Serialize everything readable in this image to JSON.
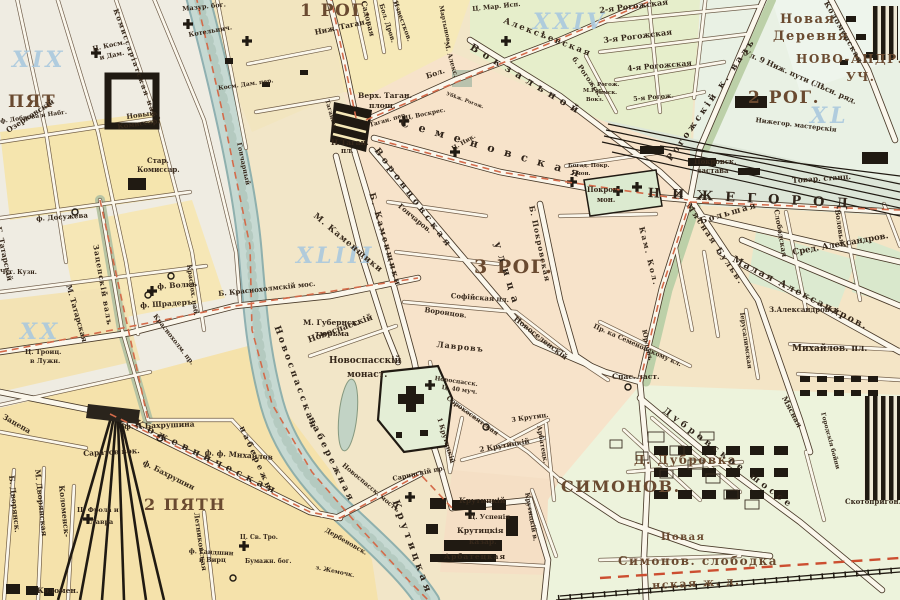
{
  "colors": {
    "paper": "#f2e6c8",
    "river": "#c6d9d2",
    "block_pink": "#f7e3ca",
    "block_yellow": "#f5e5ae",
    "block_green": "#e6eecb",
    "road_fill": "#fbf7ec",
    "building_black": "#201a12",
    "tram_line_red": "#d46b4a",
    "sheet_number_blue": "#aac9de",
    "label_brown": "#35271a",
    "district_brown": "#6a4a30"
  },
  "sheet_numbers": [
    "XIX",
    "XX",
    "XXIV",
    "XL",
    "XLIII"
  ],
  "districts": [
    "1 РОГ.",
    "2 РОГ.",
    "3 РОГ.",
    "ПЯТ",
    "2 ПЯТН",
    "СИМОНОВ."
  ],
  "labels": [
    {
      "t": "1 РОГ.",
      "x": 300,
      "y": 3,
      "s": 17,
      "c": "big",
      "n": "district-label-1-rog"
    },
    {
      "t": "2 РОГ.",
      "x": 748,
      "y": 90,
      "s": 17,
      "c": "big",
      "n": "district-label-2-rog"
    },
    {
      "t": "3 РОГ.",
      "x": 474,
      "y": 258,
      "s": 19,
      "c": "big",
      "n": "district-label-3-rog"
    },
    {
      "t": "ПЯТ",
      "x": 8,
      "y": 94,
      "s": 17,
      "c": "big",
      "n": "district-label-pyat"
    },
    {
      "t": "2 ПЯТН",
      "x": 144,
      "y": 497,
      "s": 16,
      "c": "big",
      "n": "district-label-2-pyatn"
    },
    {
      "t": "СИМОНОВ.",
      "x": 561,
      "y": 479,
      "s": 16,
      "c": "big",
      "n": "district-label-simonov"
    },
    {
      "t": "Д. Дубровка",
      "x": 634,
      "y": 455,
      "s": 12,
      "c": "big",
      "n": "village-label-dubrovka"
    },
    {
      "t": "Новая",
      "x": 780,
      "y": 14,
      "s": 13,
      "c": "big"
    },
    {
      "t": "Деревня",
      "x": 773,
      "y": 31,
      "s": 13,
      "c": "big"
    },
    {
      "t": "НОВО-АНДР.",
      "x": 796,
      "y": 54,
      "s": 12,
      "c": "big"
    },
    {
      "t": "УЧ.",
      "x": 846,
      "y": 72,
      "s": 12,
      "c": "big"
    },
    {
      "t": "Симонов. слободка",
      "x": 618,
      "y": 556,
      "s": 12,
      "c": "big"
    },
    {
      "t": "Новая",
      "x": 661,
      "y": 533,
      "s": 10,
      "c": "big"
    },
    {
      "t": "нская ж. д.",
      "x": 652,
      "y": 581,
      "r": -3,
      "s": 11,
      "c": "big"
    },
    {
      "t": "XIX",
      "x": 12,
      "y": 50,
      "s": 22,
      "c": "blue",
      "n": "sheet-number-xix"
    },
    {
      "t": "XX",
      "x": 20,
      "y": 322,
      "s": 22,
      "c": "blue",
      "n": "sheet-number-xx"
    },
    {
      "t": "XXIV",
      "x": 533,
      "y": 12,
      "s": 22,
      "c": "blue",
      "n": "sheet-number-xxiv"
    },
    {
      "t": "XL",
      "x": 810,
      "y": 106,
      "s": 22,
      "c": "blue",
      "n": "sheet-number-xl"
    },
    {
      "t": "XLIII",
      "x": 296,
      "y": 246,
      "s": 22,
      "c": "blue",
      "n": "sheet-number-xliii"
    },
    {
      "t": "Комиссаріатская наб.",
      "x": 118,
      "y": 8,
      "r": 70,
      "s": 7,
      "l": 1.5
    },
    {
      "t": "Новый",
      "x": 126,
      "y": 114,
      "r": -8,
      "s": 7
    },
    {
      "t": "Комиссар.",
      "x": 117,
      "y": 124,
      "r": -8,
      "s": 7
    },
    {
      "t": "Стар.",
      "x": 147,
      "y": 158,
      "s": 7
    },
    {
      "t": "Комиссар.",
      "x": 137,
      "y": 167,
      "s": 7
    },
    {
      "t": "Мазур. бог.",
      "x": 182,
      "y": 6,
      "r": -6,
      "s": 6.5
    },
    {
      "t": "Ц. Косм.",
      "x": 92,
      "y": 46,
      "r": -12,
      "s": 6.5
    },
    {
      "t": "и Дам.",
      "x": 99,
      "y": 55,
      "r": -12,
      "s": 6.5
    },
    {
      "t": "Котельнич.",
      "x": 188,
      "y": 32,
      "r": -10,
      "s": 6.5
    },
    {
      "t": "Косм. Дам. пер.",
      "x": 218,
      "y": 86,
      "r": -8,
      "s": 6
    },
    {
      "t": "Гончарный",
      "x": 242,
      "y": 142,
      "r": 78,
      "s": 6.5
    },
    {
      "t": "ф. Досужева",
      "x": 36,
      "y": 216,
      "r": -4,
      "s": 7
    },
    {
      "t": "Озерковскій",
      "x": 5,
      "y": 128,
      "r": -33,
      "s": 7.5
    },
    {
      "t": "ф. Доброва и Набг.",
      "x": 0,
      "y": 119,
      "r": -8,
      "s": 6
    },
    {
      "t": "Б. Татарскій",
      "x": 2,
      "y": 226,
      "r": 78,
      "s": 7.5
    },
    {
      "t": "М. Татарская",
      "x": 72,
      "y": 284,
      "r": 74,
      "s": 7.5
    },
    {
      "t": "Чуг. Кузн.",
      "x": 0,
      "y": 270,
      "s": 6
    },
    {
      "t": "Зацепскій валъ",
      "x": 99,
      "y": 244,
      "r": 80,
      "s": 7.5,
      "l": 1
    },
    {
      "t": "Ц. Троиц.",
      "x": 25,
      "y": 349,
      "s": 6.5
    },
    {
      "t": "в Лужн.",
      "x": 30,
      "y": 358,
      "s": 6.5
    },
    {
      "t": "ф. Волкъ",
      "x": 157,
      "y": 283,
      "r": -4,
      "s": 7.5
    },
    {
      "t": "ф. Шрадеръ",
      "x": 140,
      "y": 302,
      "r": -4,
      "s": 7.5
    },
    {
      "t": "Краснох. наб.",
      "x": 192,
      "y": 264,
      "r": 82,
      "s": 6.5
    },
    {
      "t": "Б. Краснохолмскій мос.",
      "x": 218,
      "y": 291,
      "r": -6,
      "s": 7
    },
    {
      "t": "Краснохолм. пр.",
      "x": 157,
      "y": 313,
      "r": 52,
      "s": 6.5
    },
    {
      "t": "Зацепа",
      "x": 5,
      "y": 413,
      "r": 30,
      "s": 7.5
    },
    {
      "t": "Б. Дворянск.",
      "x": 15,
      "y": 475,
      "r": 84,
      "s": 7.5
    },
    {
      "t": "М. Дворянская",
      "x": 41,
      "y": 469,
      "r": 84,
      "s": 7.5
    },
    {
      "t": "Коломенск-",
      "x": 65,
      "y": 485,
      "r": 84,
      "s": 7.5
    },
    {
      "t": "Коломен.",
      "x": 37,
      "y": 587,
      "s": 7.5
    },
    {
      "t": "ф. А.Бахрушина",
      "x": 124,
      "y": 423,
      "r": -2,
      "s": 7.5
    },
    {
      "t": "Саратов вок.",
      "x": 83,
      "y": 450,
      "r": -3,
      "s": 7.5,
      "n": "saratov-station-label"
    },
    {
      "t": "ф. Бахрушин",
      "x": 145,
      "y": 459,
      "r": 27,
      "s": 7.5
    },
    {
      "t": "Кожевническая",
      "x": 137,
      "y": 419,
      "r": 26,
      "s": 10,
      "l": 5,
      "c": "sp"
    },
    {
      "t": "ф. ф. Михайлов",
      "x": 205,
      "y": 449,
      "r": 4,
      "s": 7.5
    },
    {
      "t": "Ц. Фрола и",
      "x": 77,
      "y": 507,
      "s": 6.5
    },
    {
      "t": "Лавра",
      "x": 90,
      "y": 519,
      "s": 6.5
    },
    {
      "t": "ф. Гандшин",
      "x": 189,
      "y": 548,
      "r": 3,
      "s": 6.5
    },
    {
      "t": "и Вирц",
      "x": 199,
      "y": 557,
      "s": 6.5
    },
    {
      "t": "Ц. Св. Тро.",
      "x": 240,
      "y": 535,
      "s": 6
    },
    {
      "t": "Бумажн. бог.",
      "x": 245,
      "y": 559,
      "s": 6
    },
    {
      "t": "Летниковская",
      "x": 199,
      "y": 512,
      "r": 82,
      "s": 7
    },
    {
      "t": "Дербеновск.",
      "x": 327,
      "y": 527,
      "r": 30,
      "s": 6.5
    },
    {
      "t": "з. Жемочк.",
      "x": 316,
      "y": 565,
      "r": 12,
      "s": 6
    },
    {
      "t": "набережн",
      "x": 245,
      "y": 425,
      "r": 66,
      "s": 8,
      "l": 3,
      "c": "sp"
    },
    {
      "t": "Новоспасская",
      "x": 280,
      "y": 325,
      "r": 70,
      "s": 9,
      "l": 3,
      "c": "sp",
      "n": "novospasskaya-embankment-label"
    },
    {
      "t": "набережная",
      "x": 314,
      "y": 416,
      "r": 64,
      "s": 9,
      "l": 3,
      "c": "sp"
    },
    {
      "t": "Новоспасск. мостъ",
      "x": 345,
      "y": 462,
      "r": 40,
      "s": 6.5
    },
    {
      "t": "Крутицкая",
      "x": 399,
      "y": 499,
      "r": 70,
      "s": 10,
      "l": 4,
      "c": "sp"
    },
    {
      "t": "Верх. Таган.",
      "x": 358,
      "y": 92,
      "s": 7.5,
      "n": "taganka-square-label"
    },
    {
      "t": "площ.",
      "x": 369,
      "y": 102,
      "s": 7.5
    },
    {
      "t": "Н.Таган.",
      "x": 331,
      "y": 139,
      "s": 7.5
    },
    {
      "t": "пл.",
      "x": 341,
      "y": 148,
      "s": 7
    },
    {
      "t": "Таган. пер.",
      "x": 369,
      "y": 123,
      "r": -16,
      "s": 6
    },
    {
      "t": "Таганск.",
      "x": 329,
      "y": 99,
      "r": 74,
      "s": 6
    },
    {
      "t": "Ц. Воскрес.",
      "x": 405,
      "y": 116,
      "r": -12,
      "s": 6
    },
    {
      "t": "Ц. Ник.",
      "x": 451,
      "y": 147,
      "r": -30,
      "s": 6
    },
    {
      "t": "Садовая",
      "x": 367,
      "y": 0,
      "r": 76,
      "s": 7.5
    },
    {
      "t": "Бол. Дров.",
      "x": 384,
      "y": 3,
      "r": 72,
      "s": 6.5
    },
    {
      "t": "Известков.",
      "x": 398,
      "y": 0,
      "r": 70,
      "s": 6.5
    },
    {
      "t": "Ниж. Таган.",
      "x": 314,
      "y": 29,
      "r": -12,
      "s": 7.5
    },
    {
      "t": "Мартынов.",
      "x": 443,
      "y": 5,
      "r": 78,
      "s": 6
    },
    {
      "t": "М. Алекс.",
      "x": 449,
      "y": 41,
      "r": 74,
      "s": 6.5
    },
    {
      "t": "Ц. Мар. Исп.",
      "x": 472,
      "y": 6,
      "r": -6,
      "s": 6.5
    },
    {
      "t": "Убѣж. Рогож.",
      "x": 447,
      "y": 92,
      "r": 20,
      "s": 5
    },
    {
      "t": "Бол.",
      "x": 425,
      "y": 73,
      "r": -18,
      "s": 7.5
    },
    {
      "t": "Алексѣевская",
      "x": 505,
      "y": 17,
      "r": 21,
      "s": 8.5,
      "l": 2
    },
    {
      "t": "Вокзальной",
      "x": 473,
      "y": 43,
      "r": 31,
      "s": 10,
      "l": 6,
      "c": "sp"
    },
    {
      "t": "б. Рогожск.",
      "x": 576,
      "y": 56,
      "r": 55,
      "s": 7
    },
    {
      "t": "М.Рог.",
      "x": 583,
      "y": 89,
      "s": 5.5
    },
    {
      "t": "Вокз.",
      "x": 586,
      "y": 98,
      "s": 5.5
    },
    {
      "t": "Семеновская",
      "x": 402,
      "y": 118,
      "r": 16,
      "s": 11,
      "l": 10,
      "c": "sp",
      "n": "semenovskaya-street-label"
    },
    {
      "t": "Воронцовская",
      "x": 379,
      "y": 147,
      "r": 53,
      "s": 9,
      "l": 4,
      "c": "sp"
    },
    {
      "t": "улица",
      "x": 501,
      "y": 241,
      "r": 73,
      "s": 10,
      "l": 7,
      "c": "sp"
    },
    {
      "t": "Б. Каменщики",
      "x": 375,
      "y": 192,
      "r": 74,
      "s": 8.5,
      "l": 2
    },
    {
      "t": "М. Каменщики",
      "x": 317,
      "y": 212,
      "r": 40,
      "s": 8.5,
      "l": 1
    },
    {
      "t": "Гончаров.",
      "x": 401,
      "y": 203,
      "r": 40,
      "s": 7
    },
    {
      "t": "М. Губернск.",
      "x": 303,
      "y": 319,
      "s": 7.5
    },
    {
      "t": "тюрьма",
      "x": 315,
      "y": 330,
      "s": 7.5
    },
    {
      "t": "Новоспасскій",
      "x": 307,
      "y": 337,
      "r": -20,
      "s": 8.5
    },
    {
      "t": "Новоспасскій",
      "x": 329,
      "y": 357,
      "s": 9,
      "n": "novospassky-monastery-label"
    },
    {
      "t": "монаст.",
      "x": 347,
      "y": 371,
      "s": 9
    },
    {
      "t": "Новоспасск.",
      "x": 435,
      "y": 376,
      "r": 8,
      "s": 6
    },
    {
      "t": "Ц. 40 муч.",
      "x": 442,
      "y": 385,
      "r": 8,
      "s": 6
    },
    {
      "t": "Сорокосвятская",
      "x": 449,
      "y": 395,
      "r": 36,
      "s": 6.5
    },
    {
      "t": "Лавровъ",
      "x": 437,
      "y": 341,
      "r": 6,
      "s": 8,
      "l": 1
    },
    {
      "t": "Воронцов.",
      "x": 425,
      "y": 307,
      "r": 8,
      "s": 7
    },
    {
      "t": "Софійская пл.",
      "x": 451,
      "y": 293,
      "r": 4,
      "s": 7
    },
    {
      "t": "Новоселенскій",
      "x": 517,
      "y": 315,
      "r": 38,
      "s": 7.5
    },
    {
      "t": "Б. Покровская",
      "x": 535,
      "y": 205,
      "r": 78,
      "s": 7.5,
      "l": 1
    },
    {
      "t": "Покров.",
      "x": 587,
      "y": 187,
      "s": 7,
      "n": "pokrovsky-monastery-label"
    },
    {
      "t": "мон.",
      "x": 597,
      "y": 197,
      "s": 7
    },
    {
      "t": "Богад. Покр.",
      "x": 568,
      "y": 164,
      "s": 5.5
    },
    {
      "t": "мон.",
      "x": 576,
      "y": 172,
      "s": 5.5
    },
    {
      "t": "Кам. Кол.",
      "x": 645,
      "y": 226,
      "r": 76,
      "s": 7.5,
      "l": 2
    },
    {
      "t": "Рогожскій к. валъ",
      "x": 666,
      "y": 158,
      "r": -55,
      "s": 9,
      "l": 3,
      "c": "sp"
    },
    {
      "t": "Покровск.",
      "x": 694,
      "y": 159,
      "s": 7
    },
    {
      "t": "застава",
      "x": 697,
      "y": 168,
      "s": 7
    },
    {
      "t": "НИЖЕГОРОД",
      "x": 648,
      "y": 188,
      "r": 3,
      "s": 13,
      "l": 12,
      "c": "sp",
      "n": "nizhegorodskaya-street-label"
    },
    {
      "t": "Товар. станц.",
      "x": 792,
      "y": 177,
      "r": -4,
      "s": 7.5
    },
    {
      "t": "Нижегор. мастерскія",
      "x": 756,
      "y": 117,
      "r": 7,
      "s": 6.5
    },
    {
      "t": "Ул. 9 Ниж. пути (Лѣсн. ряд.",
      "x": 746,
      "y": 49,
      "r": 24,
      "s": 7.5
    },
    {
      "t": "Коломенская",
      "x": 829,
      "y": 0,
      "r": 60,
      "s": 7.5,
      "l": 1
    },
    {
      "t": "2-я Рогожская",
      "x": 599,
      "y": 7,
      "r": -7,
      "s": 8
    },
    {
      "t": "3-я Рогожская",
      "x": 603,
      "y": 37,
      "r": -7,
      "s": 8
    },
    {
      "t": "4-я Рогожская",
      "x": 627,
      "y": 65,
      "r": -5,
      "s": 7.5
    },
    {
      "t": "5-я Рогож.",
      "x": 633,
      "y": 96,
      "r": -5,
      "s": 6.5
    },
    {
      "t": "Рогож.",
      "x": 597,
      "y": 83,
      "s": 5.5
    },
    {
      "t": "ямск.",
      "x": 599,
      "y": 91,
      "s": 5.5
    },
    {
      "t": "Большая",
      "x": 699,
      "y": 218,
      "r": -16,
      "s": 8.5,
      "l": 2
    },
    {
      "t": "Слободская",
      "x": 779,
      "y": 209,
      "r": 80,
      "s": 7
    },
    {
      "t": "Воловья",
      "x": 840,
      "y": 209,
      "r": 82,
      "s": 7
    },
    {
      "t": "Сред. Александров.",
      "x": 792,
      "y": 249,
      "r": -10,
      "s": 8.5
    },
    {
      "t": "Малая Александров.",
      "x": 735,
      "y": 255,
      "r": 27,
      "s": 9.5,
      "l": 2
    },
    {
      "t": "З.Александровск.",
      "x": 769,
      "y": 307,
      "s": 7
    },
    {
      "t": "Михайлов. пл.",
      "x": 792,
      "y": 345,
      "s": 9
    },
    {
      "t": "Мясная Бульв.",
      "x": 691,
      "y": 202,
      "r": 56,
      "s": 8,
      "l": 2
    },
    {
      "t": "Мясная",
      "x": 787,
      "y": 395,
      "r": 62,
      "s": 7.5
    },
    {
      "t": "Пр. ка Семеновскому кл.",
      "x": 595,
      "y": 323,
      "r": 24,
      "s": 6.5
    },
    {
      "t": "Юрловъ",
      "x": 647,
      "y": 329,
      "r": 78,
      "s": 6.5
    },
    {
      "t": "Спас. заст.",
      "x": 612,
      "y": 373,
      "s": 7.5
    },
    {
      "t": "Іерусалимская",
      "x": 745,
      "y": 312,
      "r": 82,
      "s": 6.5
    },
    {
      "t": "Дубровское шоссе",
      "x": 666,
      "y": 407,
      "r": 37,
      "s": 9,
      "l": 4,
      "c": "sp"
    },
    {
      "t": "Скотопригон.",
      "x": 845,
      "y": 499,
      "s": 7
    },
    {
      "t": "Городскія бойни",
      "x": 825,
      "y": 412,
      "r": 75,
      "s": 6
    },
    {
      "t": "Арбатецк.",
      "x": 542,
      "y": 425,
      "r": 80,
      "s": 6.5
    },
    {
      "t": "Арбатецкая",
      "x": 444,
      "y": 553,
      "s": 7.5,
      "l": 1
    },
    {
      "t": "Крутицкій в.",
      "x": 530,
      "y": 492,
      "r": 80,
      "s": 6.5
    },
    {
      "t": "1 Крутицкій",
      "x": 442,
      "y": 417,
      "r": 73,
      "s": 6.5
    },
    {
      "t": "2 Крутицкій",
      "x": 479,
      "y": 447,
      "r": -10,
      "s": 7
    },
    {
      "t": "3 Крутиц.",
      "x": 511,
      "y": 417,
      "r": -8,
      "s": 6.5
    },
    {
      "t": "Крутицкій",
      "x": 459,
      "y": 497,
      "s": 7.5,
      "n": "krutitsky-barracks-label"
    },
    {
      "t": "Ц. Успенія",
      "x": 469,
      "y": 514,
      "s": 6.5
    },
    {
      "t": "Крутицкія",
      "x": 457,
      "y": 527,
      "s": 7.5
    },
    {
      "t": "казар.",
      "x": 469,
      "y": 538,
      "s": 7.5
    },
    {
      "t": "Саринскій пр.",
      "x": 392,
      "y": 476,
      "r": -12,
      "s": 6.5
    }
  ]
}
